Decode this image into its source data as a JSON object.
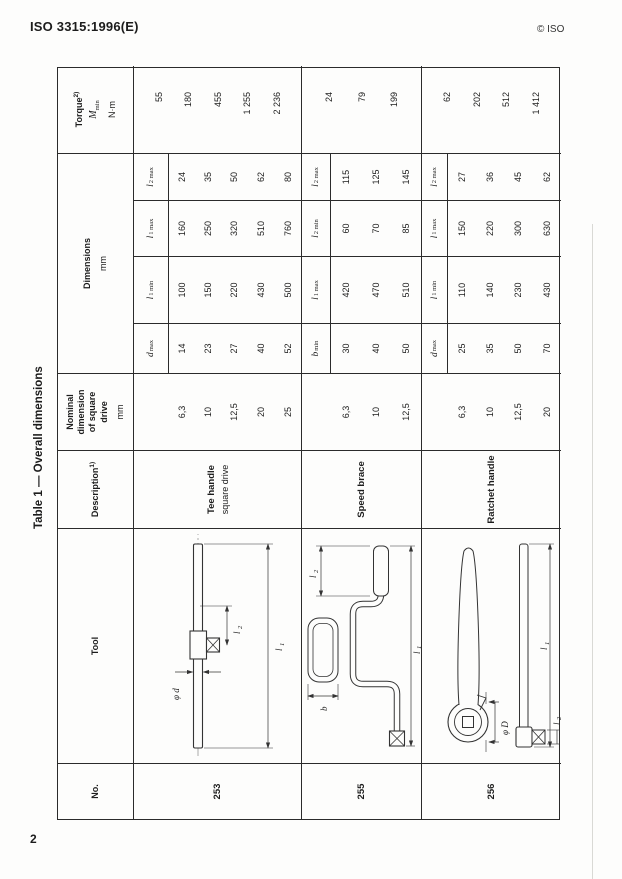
{
  "page": {
    "header_left": "ISO 3315:1996(E)",
    "header_right": "© ISO",
    "page_number": "2",
    "table_title": "Table 1 — Overall dimensions"
  },
  "table": {
    "header": {
      "no": "No.",
      "tool": "Tool",
      "description": "Description",
      "description_sup": "1)",
      "nominal_lines": [
        "Nominal",
        "dimension",
        "of square",
        "drive"
      ],
      "nominal_unit": "mm",
      "dimensions_title": "Dimensions",
      "dimensions_unit": "mm",
      "torque_title": "Torque",
      "torque_sup": "2)",
      "torque_symbol": "M",
      "torque_symbol_sub": "min",
      "torque_unit": "N·m"
    },
    "sections": [
      {
        "no": "253",
        "name_bold": "Tee handle",
        "name_sub": "square drive",
        "drawing_labels": {
          "dia": "φ d",
          "l1b": "l",
          "l1s": "1",
          "l2b": "l",
          "l2s": "2"
        },
        "col_labels": [
          {
            "b": "d",
            "s": "max"
          },
          {
            "b": "l",
            "s": "1 min"
          },
          {
            "b": "l",
            "s": "1 max"
          },
          {
            "b": "l",
            "s": "2 max"
          }
        ],
        "sizes": [
          "6,3",
          "10",
          "12,5",
          "20",
          "25"
        ],
        "c5": [
          "14",
          "23",
          "27",
          "40",
          "52"
        ],
        "c6": [
          "100",
          "150",
          "220",
          "430",
          "500"
        ],
        "c7": [
          "160",
          "250",
          "320",
          "510",
          "760"
        ],
        "c8": [
          "24",
          "35",
          "50",
          "62",
          "80"
        ],
        "torque": [
          "55",
          "180",
          "455",
          "1 255",
          "2 236"
        ]
      },
      {
        "no": "255",
        "name_bold": "Speed brace",
        "name_sub": "",
        "drawing_labels": {
          "b": "b",
          "l1b": "l",
          "l1s": "1",
          "l2b": "l",
          "l2s": "2"
        },
        "col_labels": [
          {
            "b": "b",
            "s": "min"
          },
          {
            "b": "l",
            "s": "1 max"
          },
          {
            "b": "l",
            "s": "2 min"
          },
          {
            "b": "l",
            "s": "2 max"
          }
        ],
        "sizes": [
          "6,3",
          "10",
          "12,5"
        ],
        "c5": [
          "30",
          "40",
          "50"
        ],
        "c6": [
          "420",
          "470",
          "510"
        ],
        "c7": [
          "60",
          "70",
          "85"
        ],
        "c8": [
          "115",
          "125",
          "145"
        ],
        "torque": [
          "24",
          "79",
          "199"
        ]
      },
      {
        "no": "256",
        "name_bold": "Ratchet handle",
        "name_sub": "",
        "drawing_labels": {
          "dia": "φ D",
          "l1b": "l",
          "l1s": "1",
          "l2b": "l",
          "l2s": "2"
        },
        "col_labels": [
          {
            "b": "d",
            "s": "max"
          },
          {
            "b": "l",
            "s": "1 min"
          },
          {
            "b": "l",
            "s": "1 max"
          },
          {
            "b": "l",
            "s": "2 max"
          }
        ],
        "sizes": [
          "6,3",
          "10",
          "12,5",
          "20"
        ],
        "c5": [
          "25",
          "35",
          "50",
          "70"
        ],
        "c6": [
          "110",
          "140",
          "230",
          "430"
        ],
        "c7": [
          "150",
          "220",
          "300",
          "630"
        ],
        "c8": [
          "27",
          "36",
          "45",
          "62"
        ],
        "torque": [
          "62",
          "202",
          "512",
          "1 412"
        ]
      }
    ]
  }
}
